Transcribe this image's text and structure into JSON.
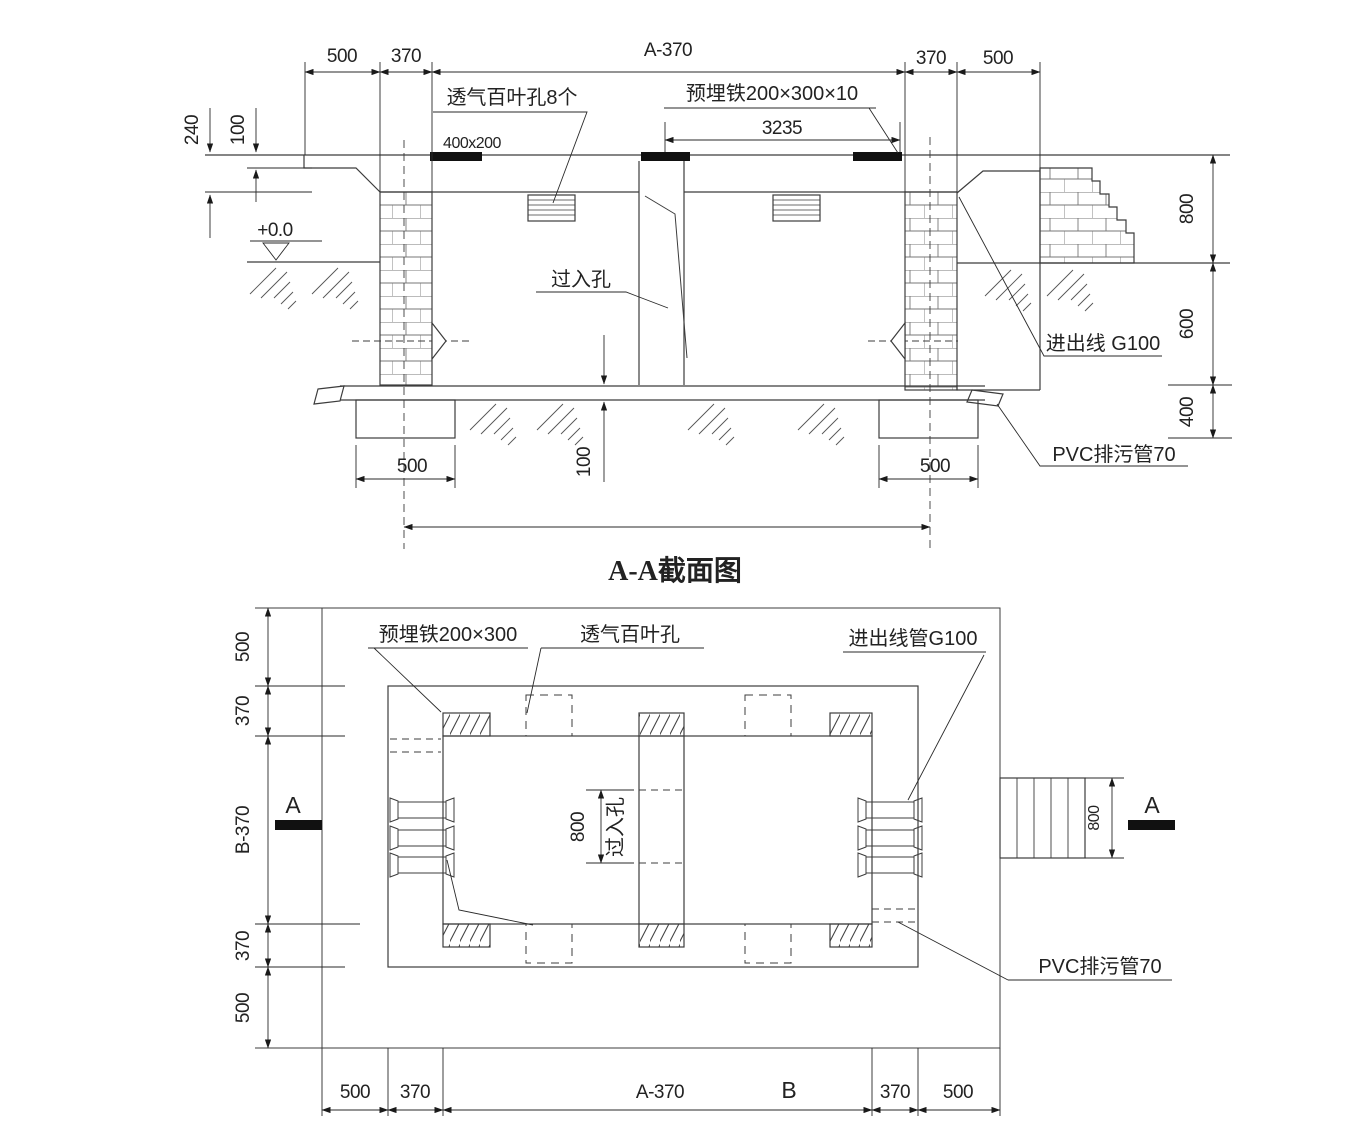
{
  "section": {
    "title": "A-A截面图",
    "top_dims": [
      "500",
      "370",
      "A-370",
      "370",
      "500"
    ],
    "dim_3235": "3235",
    "label_louver": "透气百叶孔8个",
    "label_embed": "预埋铁200×300×10",
    "label_size": "400x200",
    "dim_240": "240",
    "dim_100_slab": "100",
    "level": "+0.0",
    "label_manhole": "过入孔",
    "label_inout": "进出线  G100",
    "right_dims": [
      "800",
      "600",
      "400"
    ],
    "label_pvc": "PVC排污管70",
    "dim_500_foot_left": "500",
    "dim_500_foot_right": "500",
    "dim_100_floor": "100"
  },
  "plan": {
    "label_embed": "预埋铁200×300",
    "label_louver": "透气百叶孔",
    "label_conduit": "进出线管G100",
    "label_pvc": "PVC排污管70",
    "label_manhole": "过入孔",
    "dim_800_manhole": "800",
    "dim_800_chute": "800",
    "left_dims": [
      "500",
      "370",
      "B-370",
      "370",
      "500"
    ],
    "bottom_dims": [
      "500",
      "370",
      "A-370",
      "B",
      "370",
      "500"
    ],
    "marker_left": "A",
    "marker_right": "A"
  }
}
